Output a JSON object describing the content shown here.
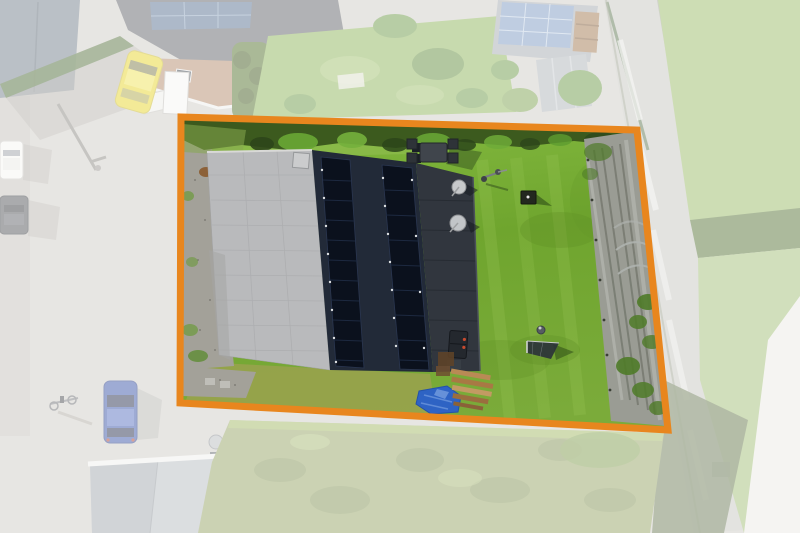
{
  "image": {
    "type": "aerial-drone-photograph",
    "description": "Top-down drone photo of a residential plot outlined with an orange boundary; gabled house with two strips of rooftop solar panels, dark side deck, vivid green back garden with patio set, soccer goal, blue tarp and a weed-fabric vegetable path; surrounding street, neighbouring houses, cars and gardens are faded white outside the boundary.",
    "width": 800,
    "height": 533
  },
  "boundary": {
    "label": "plot-outline",
    "points": "181,117 637,130 668,430 180,403",
    "color": "#E8861E",
    "stroke_width": 7
  },
  "fade": {
    "path": "M0,0 H800 V533 H0 Z M181,117 L637,130 L668,430 L180,403 Z",
    "color": "#FFFFFF",
    "opacity": 0.5
  },
  "palette": {
    "base_ground": "#CFCCC6",
    "lawn_top": "#86BC42",
    "lawn_mid": "#6FA52E",
    "lawn_low": "#7BAB3A",
    "lawn_outside": "#8FB45C",
    "lawn_dry": "#9AA24D",
    "hedge": "#3C5A1E",
    "bush": "#67A434",
    "gravel": "#A3A199",
    "roof_light": "#B9BABC",
    "roof_dark": "#222A38",
    "solar": "#0B111D",
    "deck": "#31363E",
    "path_fabric": "#9A9C94",
    "fabric_outside": "#C6C6C0",
    "tarp": "#2E63C4",
    "car_yellow": "#E6D52F",
    "car_blue": "#3D57A9",
    "car_white": "#F4F4F1",
    "car_dark": "#54565A",
    "neighbor_roof": "#62656A",
    "neighbor_roof_brown": "#B48D6E",
    "neighbor_solar": "#5A7393",
    "shed_roof": "#A4AAB0",
    "shed_solar": "#7E9AC2",
    "bottom_roof": "#B7BCC1",
    "parasol": "#F2E7E4",
    "scrub": "#97A566",
    "wood": "#A27A52"
  }
}
